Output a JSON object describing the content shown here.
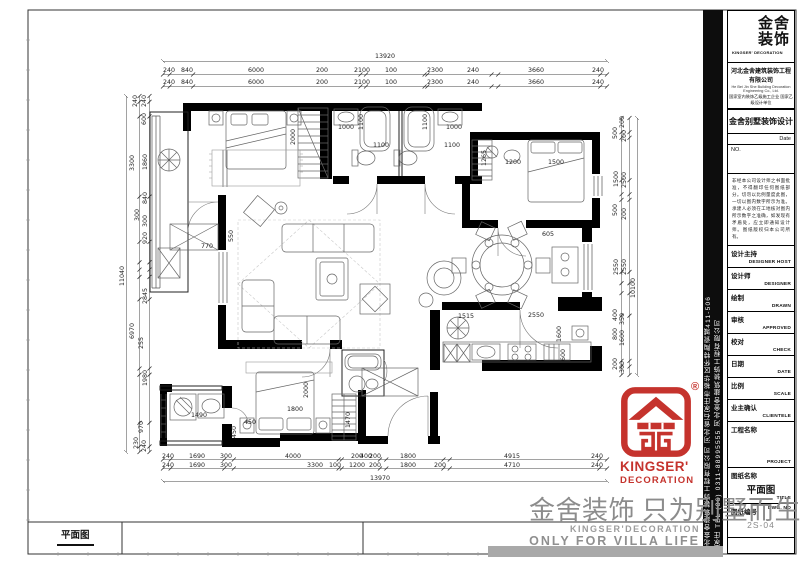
{
  "sheet": {
    "dwg_scale_label": "2S-04"
  },
  "sidebar": {
    "line1": "河北金舍建筑装饰工程有限公司  河北省石家庄市裕华区怀特陶瓷城411-506",
    "line2": "石家庄 TEL (86) 0311-88995555  河北金舍建筑装饰工程有限公司"
  },
  "title_block": {
    "brand_cn_1": "金舍",
    "brand_cn_2": "装饰",
    "brand_en": "KINGSER' DECORATION",
    "company": "河北金舍建筑装饰工程有限公司",
    "company_en": "He Bei Jin She Building Decoration Engineering Co., Ltd.",
    "certs": "国家室内装饰乙级施工企业 国家乙级设计单位",
    "project_title": "金舍别墅装饰设计",
    "date_label": "Date",
    "no_label": "NO.",
    "disclaimer": "非经本公司设计师之书面批准，不得翻印任何图纸部分。切勿以比例量度此图，一切以图内数字所示为准。承建人必须在工地核对图内所示数字之准确，如发现有矛盾处，应立即通知设计师。图纸版权归本公司所有。",
    "rows": [
      {
        "cn": "设计主持",
        "en": "DESIGNER HOST"
      },
      {
        "cn": "设计师",
        "en": "DESIGNER"
      },
      {
        "cn": "绘制",
        "en": "DRAWN"
      },
      {
        "cn": "审核",
        "en": "APPROVED"
      },
      {
        "cn": "校对",
        "en": "CHECK"
      },
      {
        "cn": "日期",
        "en": "DATE"
      },
      {
        "cn": "比例",
        "en": "SCALE"
      },
      {
        "cn": "业主确认",
        "en": "CLIENTELE"
      },
      {
        "cn": "工程名称",
        "en": "PROJECT",
        "h": "tall"
      },
      {
        "cn": "图纸名称",
        "en": "TITLE",
        "h": "titlerow",
        "value": "平面图"
      }
    ],
    "dwg_no_cn": "图纸编号",
    "dwg_no_en": "DWG. NO",
    "dwg_no": "2S-04"
  },
  "red_logo": {
    "reg": "®",
    "en1": "KINGSER'",
    "en2": "DECORATION"
  },
  "watermark": {
    "cn": "金舍装饰 只为别墅而生。",
    "en1": "KINGSER'DECORATION",
    "en2": "ONLY FOR VILLA LIFE"
  },
  "footer": {
    "plan_label": "平面图"
  },
  "plan": {
    "dims": [
      [
        "13920",
        385,
        58
      ],
      [
        "240",
        169,
        72
      ],
      [
        "840",
        187,
        72
      ],
      [
        "6000",
        256,
        72
      ],
      [
        "200",
        322,
        72
      ],
      [
        "2100",
        362,
        72
      ],
      [
        "100",
        391,
        72
      ],
      [
        "2300",
        435,
        72
      ],
      [
        "240",
        473,
        72
      ],
      [
        "3660",
        536,
        72
      ],
      [
        "240",
        598,
        72
      ],
      [
        "240",
        169,
        84
      ],
      [
        "840",
        187,
        84
      ],
      [
        "6000",
        256,
        84
      ],
      [
        "200",
        322,
        84
      ],
      [
        "2100",
        362,
        84
      ],
      [
        "100",
        391,
        84
      ],
      [
        "2300",
        435,
        84
      ],
      [
        "240",
        473,
        84
      ],
      [
        "3660",
        536,
        84
      ],
      [
        "240",
        598,
        84
      ],
      [
        "240",
        137,
        101,
        1
      ],
      [
        "240",
        146,
        101,
        1
      ],
      [
        "600",
        146,
        119,
        1
      ],
      [
        "3300",
        134,
        163,
        1
      ],
      [
        "1860",
        147,
        162,
        1
      ],
      [
        "840",
        147,
        198,
        1
      ],
      [
        "300",
        139,
        215,
        1
      ],
      [
        "300",
        147,
        221,
        1
      ],
      [
        "920",
        147,
        238,
        1
      ],
      [
        "11040",
        124,
        276,
        1
      ],
      [
        "2845",
        147,
        296,
        1
      ],
      [
        "6970",
        134,
        331,
        1
      ],
      [
        "255",
        143,
        343,
        1
      ],
      [
        "1980",
        147,
        378,
        1
      ],
      [
        "970",
        143,
        427,
        1
      ],
      [
        "230",
        138,
        443,
        1
      ],
      [
        "240",
        146,
        446,
        1
      ],
      [
        "200",
        624,
        122,
        1
      ],
      [
        "500",
        617,
        133,
        1
      ],
      [
        "200",
        626,
        136,
        1
      ],
      [
        "1500",
        618,
        179,
        1
      ],
      [
        "2500",
        626,
        180,
        1
      ],
      [
        "500",
        617,
        210,
        1
      ],
      [
        "200",
        626,
        214,
        1
      ],
      [
        "2550",
        618,
        267,
        1
      ],
      [
        "2550",
        626,
        267,
        1
      ],
      [
        "10100",
        635,
        288,
        1
      ],
      [
        "400",
        617,
        315,
        1
      ],
      [
        "350",
        624,
        319,
        1
      ],
      [
        "800",
        617,
        334,
        1
      ],
      [
        "1600",
        624,
        338,
        1
      ],
      [
        "200",
        617,
        364,
        1
      ],
      [
        "300",
        624,
        367,
        1
      ],
      [
        "240",
        168,
        458
      ],
      [
        "1690",
        197,
        458
      ],
      [
        "300",
        226,
        458
      ],
      [
        "4000",
        293,
        458
      ],
      [
        "200",
        357,
        458
      ],
      [
        "400",
        366,
        458
      ],
      [
        "200",
        375,
        458
      ],
      [
        "1800",
        408,
        458
      ],
      [
        "4915",
        512,
        458
      ],
      [
        "240",
        597,
        458
      ],
      [
        "240",
        168,
        467
      ],
      [
        "1690",
        197,
        467
      ],
      [
        "300",
        226,
        467
      ],
      [
        "3300",
        315,
        467
      ],
      [
        "100",
        335,
        467
      ],
      [
        "1200",
        357,
        467
      ],
      [
        "200",
        375,
        467
      ],
      [
        "1800",
        408,
        467
      ],
      [
        "200",
        440,
        467
      ],
      [
        "4710",
        512,
        467
      ],
      [
        "240",
        597,
        467
      ],
      [
        "13970",
        380,
        480
      ],
      [
        "2000",
        295,
        137,
        1
      ],
      [
        "1000",
        346,
        129
      ],
      [
        "1100",
        363,
        122,
        1
      ],
      [
        "1100",
        381,
        147
      ],
      [
        "1100",
        427,
        122,
        1
      ],
      [
        "1000",
        454,
        129
      ],
      [
        "1100",
        452,
        147
      ],
      [
        "1265",
        486,
        158,
        1
      ],
      [
        "1200",
        513,
        164
      ],
      [
        "1500",
        556,
        164
      ],
      [
        "770",
        207,
        248
      ],
      [
        "550",
        233,
        236,
        1
      ],
      [
        "605",
        548,
        236
      ],
      [
        "1515",
        466,
        318
      ],
      [
        "2550",
        536,
        317
      ],
      [
        "1600",
        561,
        334,
        1
      ],
      [
        "600",
        565,
        355,
        1
      ],
      [
        "1490",
        199,
        417
      ],
      [
        "450",
        250,
        424
      ],
      [
        "450",
        236,
        432,
        1
      ],
      [
        "2000",
        308,
        390,
        1
      ],
      [
        "1800",
        295,
        411
      ],
      [
        "1470",
        350,
        420,
        1
      ]
    ],
    "chains": [
      {
        "o": "h",
        "pos": 74.5,
        "from": 163,
        "to": 607,
        "mm": [
          240,
          840,
          6000,
          200,
          2100,
          100,
          2300,
          240,
          3660,
          240
        ]
      },
      {
        "o": "h",
        "pos": 86.5,
        "from": 163,
        "to": 607,
        "mm": [
          240,
          840,
          6000,
          200,
          2100,
          100,
          2300,
          240,
          3660,
          240
        ]
      },
      {
        "o": "h",
        "pos": 459.5,
        "from": 163,
        "to": 607,
        "mm": [
          240,
          1690,
          300,
          3300,
          100,
          1200,
          200,
          1800,
          200,
          4710,
          240
        ]
      },
      {
        "o": "h",
        "pos": 468.5,
        "from": 163,
        "to": 607,
        "mm": [
          240,
          1690,
          300,
          3300,
          100,
          1200,
          200,
          1800,
          200,
          4710,
          240
        ]
      },
      {
        "o": "v",
        "pos": 139.5,
        "from": 96,
        "to": 452,
        "mm": [
          240,
          600,
          3300,
          1860,
          840,
          300,
          300,
          920,
          2845,
          255,
          1980,
          970,
          230
        ]
      },
      {
        "o": "v",
        "pos": 149.5,
        "from": 96,
        "to": 452,
        "mm": [
          240,
          600,
          3300,
          1860,
          840,
          300,
          300,
          920,
          2845,
          255,
          1980,
          970,
          230
        ]
      },
      {
        "o": "v",
        "pos": 621.5,
        "from": 118,
        "to": 375,
        "mm": [
          500,
          200,
          1500,
          500,
          200,
          2550,
          400,
          350,
          800,
          1600,
          200,
          300
        ]
      },
      {
        "o": "v",
        "pos": 629.5,
        "from": 118,
        "to": 375,
        "mm": [
          500,
          200,
          1500,
          500,
          200,
          2550,
          400,
          350,
          800,
          1600,
          200,
          300
        ]
      }
    ]
  }
}
